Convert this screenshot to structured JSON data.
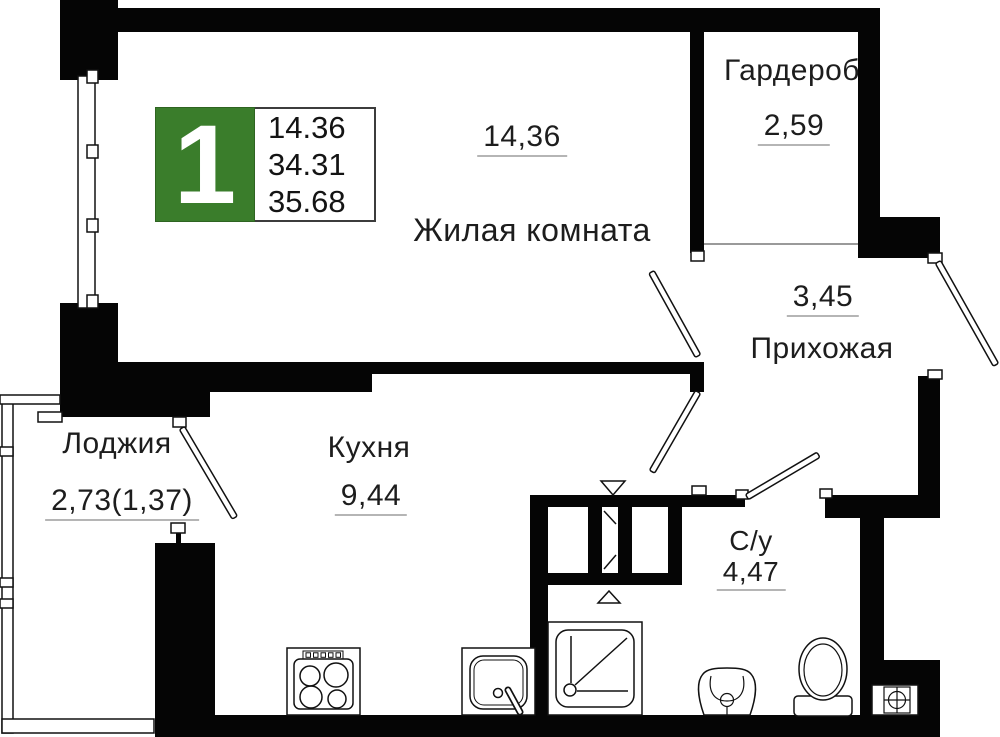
{
  "plan": {
    "unit_badge": {
      "number": "1",
      "lines": [
        "14.36",
        "34.31",
        "35.68"
      ]
    },
    "rooms": {
      "living": {
        "name": "Жилая комната",
        "area": "14,36"
      },
      "wardrobe": {
        "name": "Гардероб",
        "area": "2,59"
      },
      "hallway": {
        "name": "Прихожая",
        "area": "3,45"
      },
      "kitchen": {
        "name": "Кухня",
        "area": "9,44"
      },
      "loggia": {
        "name": "Лоджия",
        "area": "2,73(1,37)"
      },
      "bathroom": {
        "name": "С/у",
        "area": "4,47"
      }
    },
    "icons": [
      "stove-icon",
      "kitchen-sink-icon",
      "shower-icon",
      "washbasin-icon",
      "toilet-icon",
      "vent-grille-icon",
      "vent-duct-triangle-icon",
      "window-icon",
      "door-swing-icon"
    ],
    "colors": {
      "wall": "#000000",
      "background": "#ffffff",
      "badge_green": "#3a7d2b",
      "underline": "#b5b5b5",
      "text": "#1d1d1d"
    }
  }
}
